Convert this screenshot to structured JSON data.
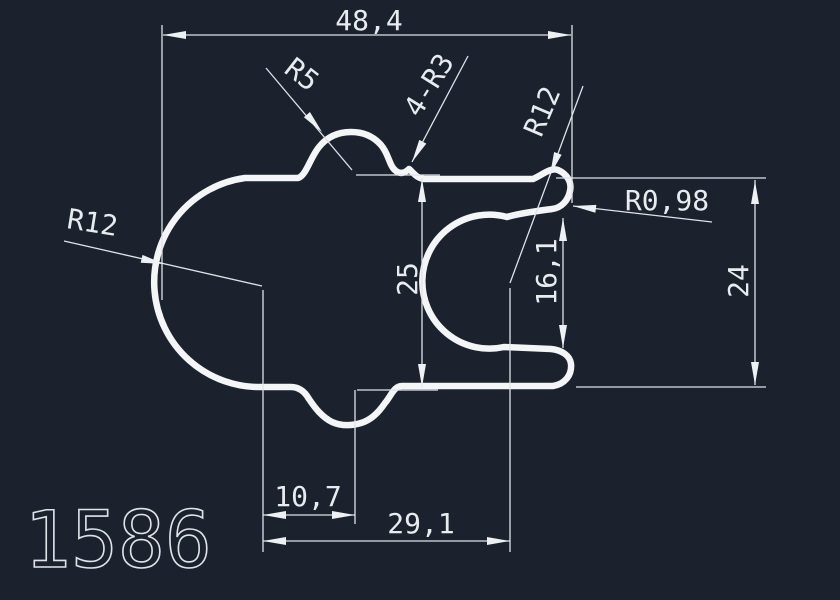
{
  "drawing": {
    "part_number": "1586",
    "background_color": "#1b212d",
    "line_color": "#e9ecef",
    "dimensions": {
      "total_width": "48,4",
      "body_height": "25",
      "opening_height": "16,1",
      "right_arm_height": "24",
      "bottom_offset_small": "10,7",
      "bottom_offset_large": "29,1"
    },
    "radius_labels": {
      "top_bump": "R5",
      "top_fillets": "4-R3",
      "left_arc": "R12",
      "right_arc": "R12",
      "lip_tip": "R0,98"
    }
  }
}
